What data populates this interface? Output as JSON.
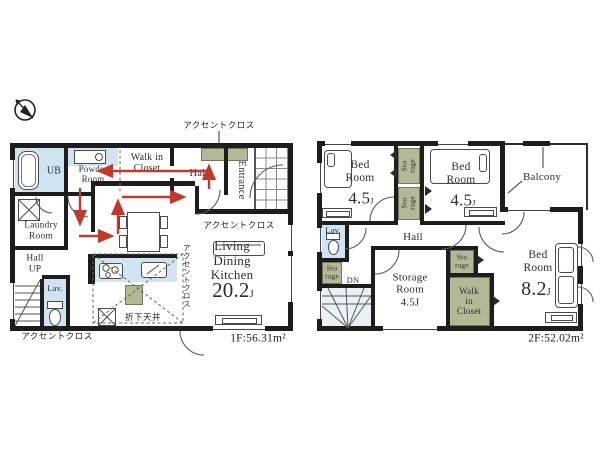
{
  "colors": {
    "wall": "#1d1d1d",
    "wet_blue": "#cfe3f1",
    "storage_green": "#b0ba96",
    "arrow_red": "#c0392b"
  },
  "units": {
    "jou": "J"
  },
  "floor1": {
    "area_label": "1F:56.31m²",
    "rooms": {
      "ub": "UB",
      "powder_room": "Powder\nRoom",
      "walk_in_closet": "Walk in\nCloset",
      "hall": "Hall",
      "entrance": "Entrance",
      "laundry_room": "Laundry\nRoom",
      "hall_up": "Hall\nUP",
      "lav": "Lav.",
      "ldk": "Living\nDining\nKitchen",
      "ldk_size": "20.2"
    },
    "notes": {
      "accent_cloth": "アクセントクロス",
      "dropped_ceiling": "折下天井"
    }
  },
  "floor2": {
    "area_label": "2F:52.02m²",
    "rooms": {
      "bedroom": "Bed\nRoom",
      "bedroom_a_size": "4.5",
      "bedroom_b_size": "4.5",
      "bedroom_c_size": "8.2",
      "balcony": "Balcony",
      "hall": "Hall",
      "lav": "Lav.",
      "storage": "Sto\nrage",
      "storage_room": "Storage\nRoom\n4.5J",
      "walk_in_closet": "Walk\nin\nCloset",
      "down": "DN"
    }
  }
}
